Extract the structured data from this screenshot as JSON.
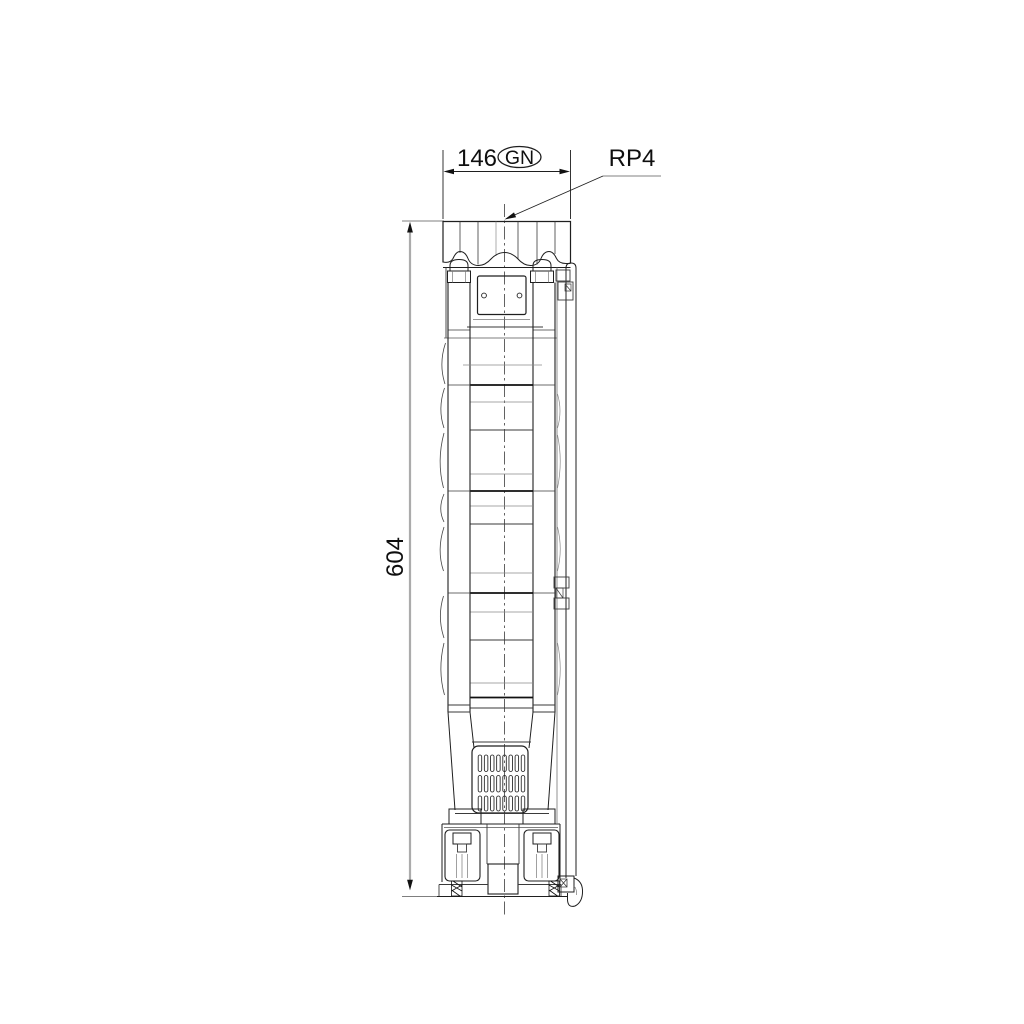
{
  "drawing": {
    "labels": {
      "width_value": "146",
      "width_tag": "GN",
      "connection": "RP4",
      "height_value": "604"
    },
    "colors": {
      "line": "#1f1f1f",
      "light_line": "#8a8a8a",
      "dimension_line": "#ababab",
      "text": "#0f0f0f",
      "background": "#ffffff"
    }
  }
}
